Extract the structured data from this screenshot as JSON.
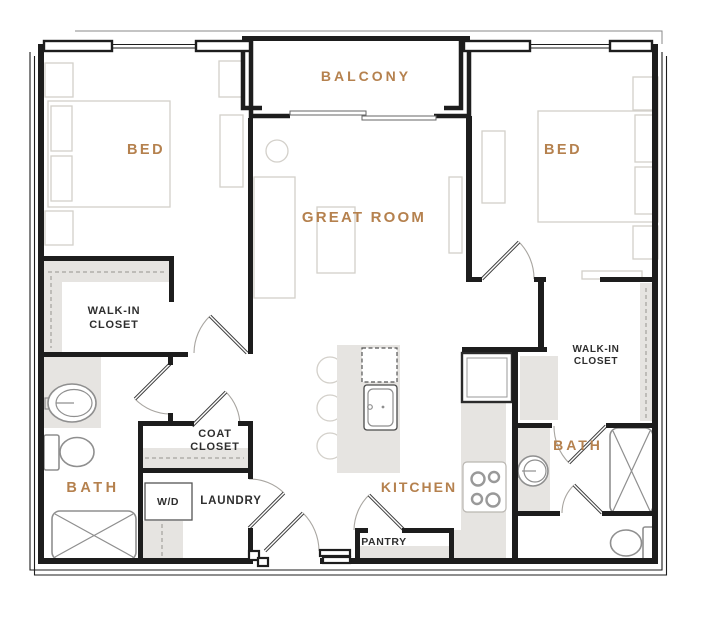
{
  "floor_plan": {
    "colors": {
      "wall": "#1d1d1d",
      "accent_label": "#b5814e",
      "dark_label": "#2e2e2e",
      "area_fill": "#e6e4e1",
      "furniture_line": "#d3d0ca",
      "fixture_line": "#8f8f8f"
    },
    "rooms": {
      "balcony": "BALCONY",
      "bed_left": "BED",
      "bed_right": "BED",
      "great_room": "GREAT ROOM",
      "kitchen": "KITCHEN",
      "bath_left": "BATH",
      "bath_right": "BATH"
    },
    "areas": {
      "walk_in_closet_left": {
        "line1": "WALK-IN",
        "line2": "CLOSET"
      },
      "walk_in_closet_right": {
        "line1": "WALK-IN",
        "line2": "CLOSET"
      },
      "coat_closet": {
        "line1": "COAT",
        "line2": "CLOSET"
      },
      "washer_dryer": "W/D",
      "laundry": "LAUNDRY",
      "pantry": "PANTRY"
    }
  }
}
